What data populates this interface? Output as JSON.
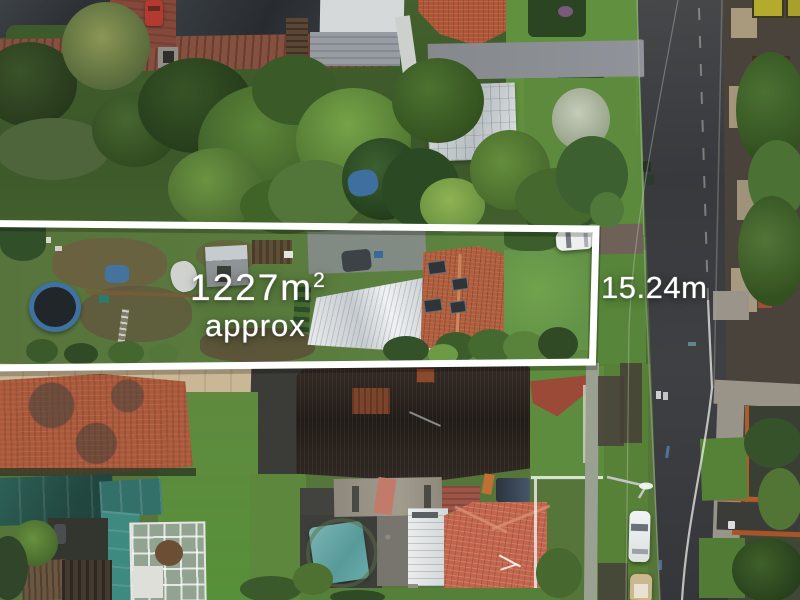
{
  "annotations": {
    "area_value": "1227m",
    "area_superscript": "2",
    "area_qualifier": "approx",
    "frontage_value": "15.24m",
    "text_color": "#ffffff",
    "boundary_color": "#ffffff"
  },
  "palette": {
    "road_asphalt": "#3b3d40",
    "lawn_green": "#5a7f3e",
    "tree_dark_green": "#2f4a24",
    "terracotta_roof": "#b05a3a",
    "salmon_roof": "#c2654c",
    "dark_roof": "#2b2522",
    "white_roof": "#e2e5e6",
    "teal_shade": "#2e6258",
    "teal_tarp": "#6aacab",
    "brick_driveway": "#7d4736"
  }
}
